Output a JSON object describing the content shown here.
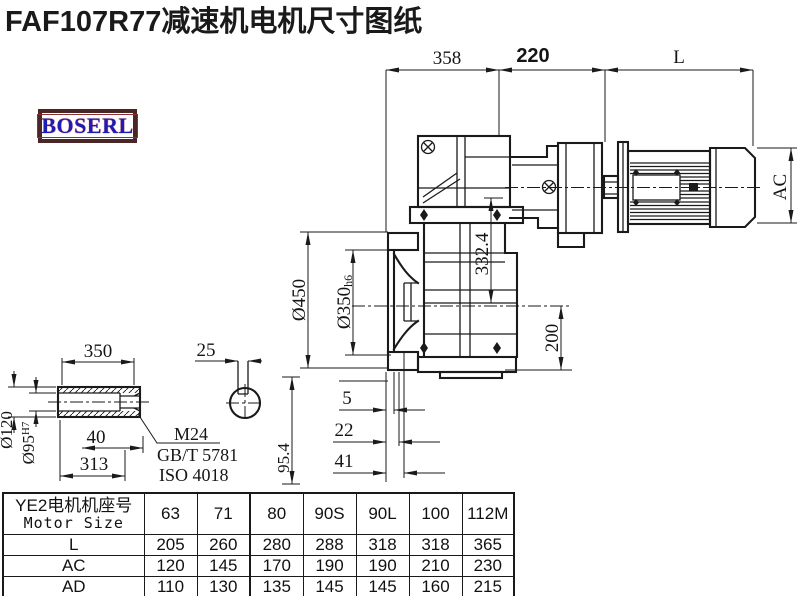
{
  "title": "FAF107R77减速机电机尺寸图纸",
  "logo": {
    "text": "BOSERL"
  },
  "dims": {
    "d358": "358",
    "d220": "220",
    "dL": "L",
    "dAC": "AC",
    "d332_4": "332.4",
    "d450": "Ø450",
    "d350": "Ø350",
    "d350_tol": "h6",
    "d200": "200",
    "d5": "5",
    "d22": "22",
    "d41": "41",
    "d95_4": "95.4",
    "d350s": "350",
    "d25": "25",
    "d120": "Ø120",
    "d95": "Ø95",
    "d95_tol": "H7",
    "d40": "40",
    "d313": "313",
    "note_m24": "M24",
    "note_gbt": "GB/T 5781",
    "note_iso": "ISO 4018"
  },
  "table": {
    "header_cn": "YE2电机机座号",
    "header_en": "Motor Size",
    "sizes": [
      "63",
      "71",
      "80",
      "90S",
      "90L",
      "100",
      "112M"
    ],
    "rows": [
      {
        "label": "L",
        "values": [
          "205",
          "260",
          "280",
          "288",
          "318",
          "318",
          "365"
        ]
      },
      {
        "label": "AC",
        "values": [
          "120",
          "145",
          "170",
          "190",
          "190",
          "210",
          "230"
        ]
      },
      {
        "label": "AD",
        "values": [
          "110",
          "130",
          "135",
          "145",
          "145",
          "160",
          "215"
        ]
      }
    ]
  }
}
